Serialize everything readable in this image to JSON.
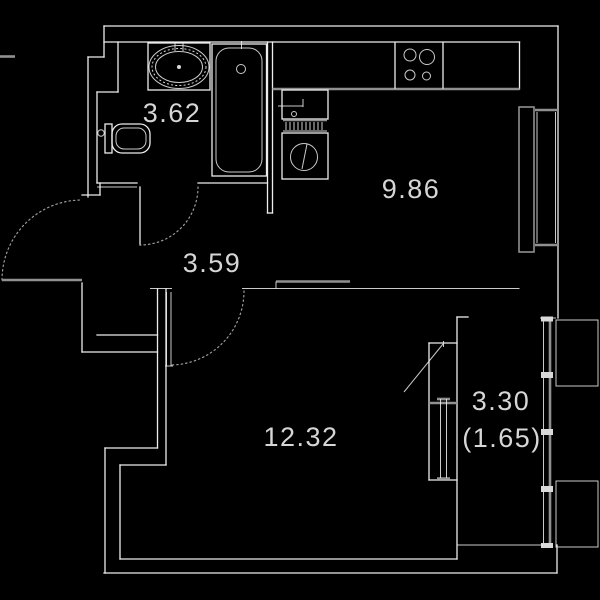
{
  "plan": {
    "type": "apartment-floor-plan",
    "units": "square meters",
    "rooms": [
      {
        "name": "bathroom",
        "area": "3.62"
      },
      {
        "name": "kitchen",
        "area": "9.86"
      },
      {
        "name": "hallway",
        "area": "3.59"
      },
      {
        "name": "room",
        "area": "12.32"
      },
      {
        "name": "balcony",
        "area": "3.30",
        "area_secondary": "(1.65)"
      }
    ],
    "fixtures": [
      "bathroom-sink",
      "bathtub",
      "toilet",
      "stove",
      "kitchen-sink",
      "washing-machine",
      "radiator",
      "entrance-door",
      "bathroom-door",
      "room-door",
      "balcony-door-window-block",
      "kitchen-window",
      "balcony-glazing"
    ],
    "colors": {
      "background": "#000000",
      "wall_line": "#ededed",
      "secondary_line": "#909090",
      "label_text": "#d6d6d6"
    }
  }
}
